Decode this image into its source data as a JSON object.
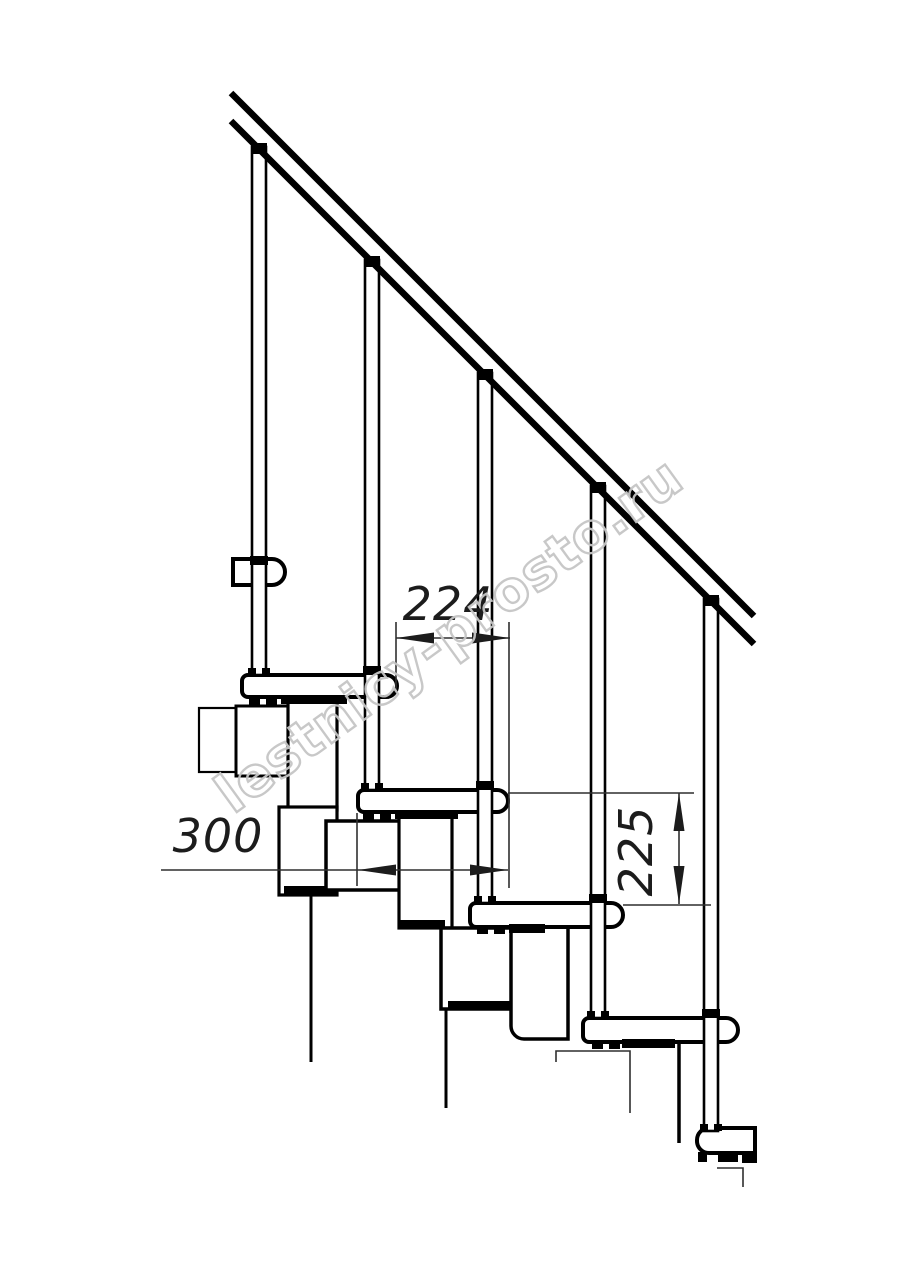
{
  "dimensions": {
    "tread_offset": {
      "label": "224"
    },
    "tread_depth": {
      "label": "300"
    },
    "riser_height": {
      "label": "225"
    }
  },
  "watermark": {
    "text": "lestnicy-prosto.ru",
    "color": "#c6c6c6"
  },
  "colors": {
    "line": "#000000",
    "dimension_line": "#2f2f2f",
    "background": "#ffffff"
  }
}
